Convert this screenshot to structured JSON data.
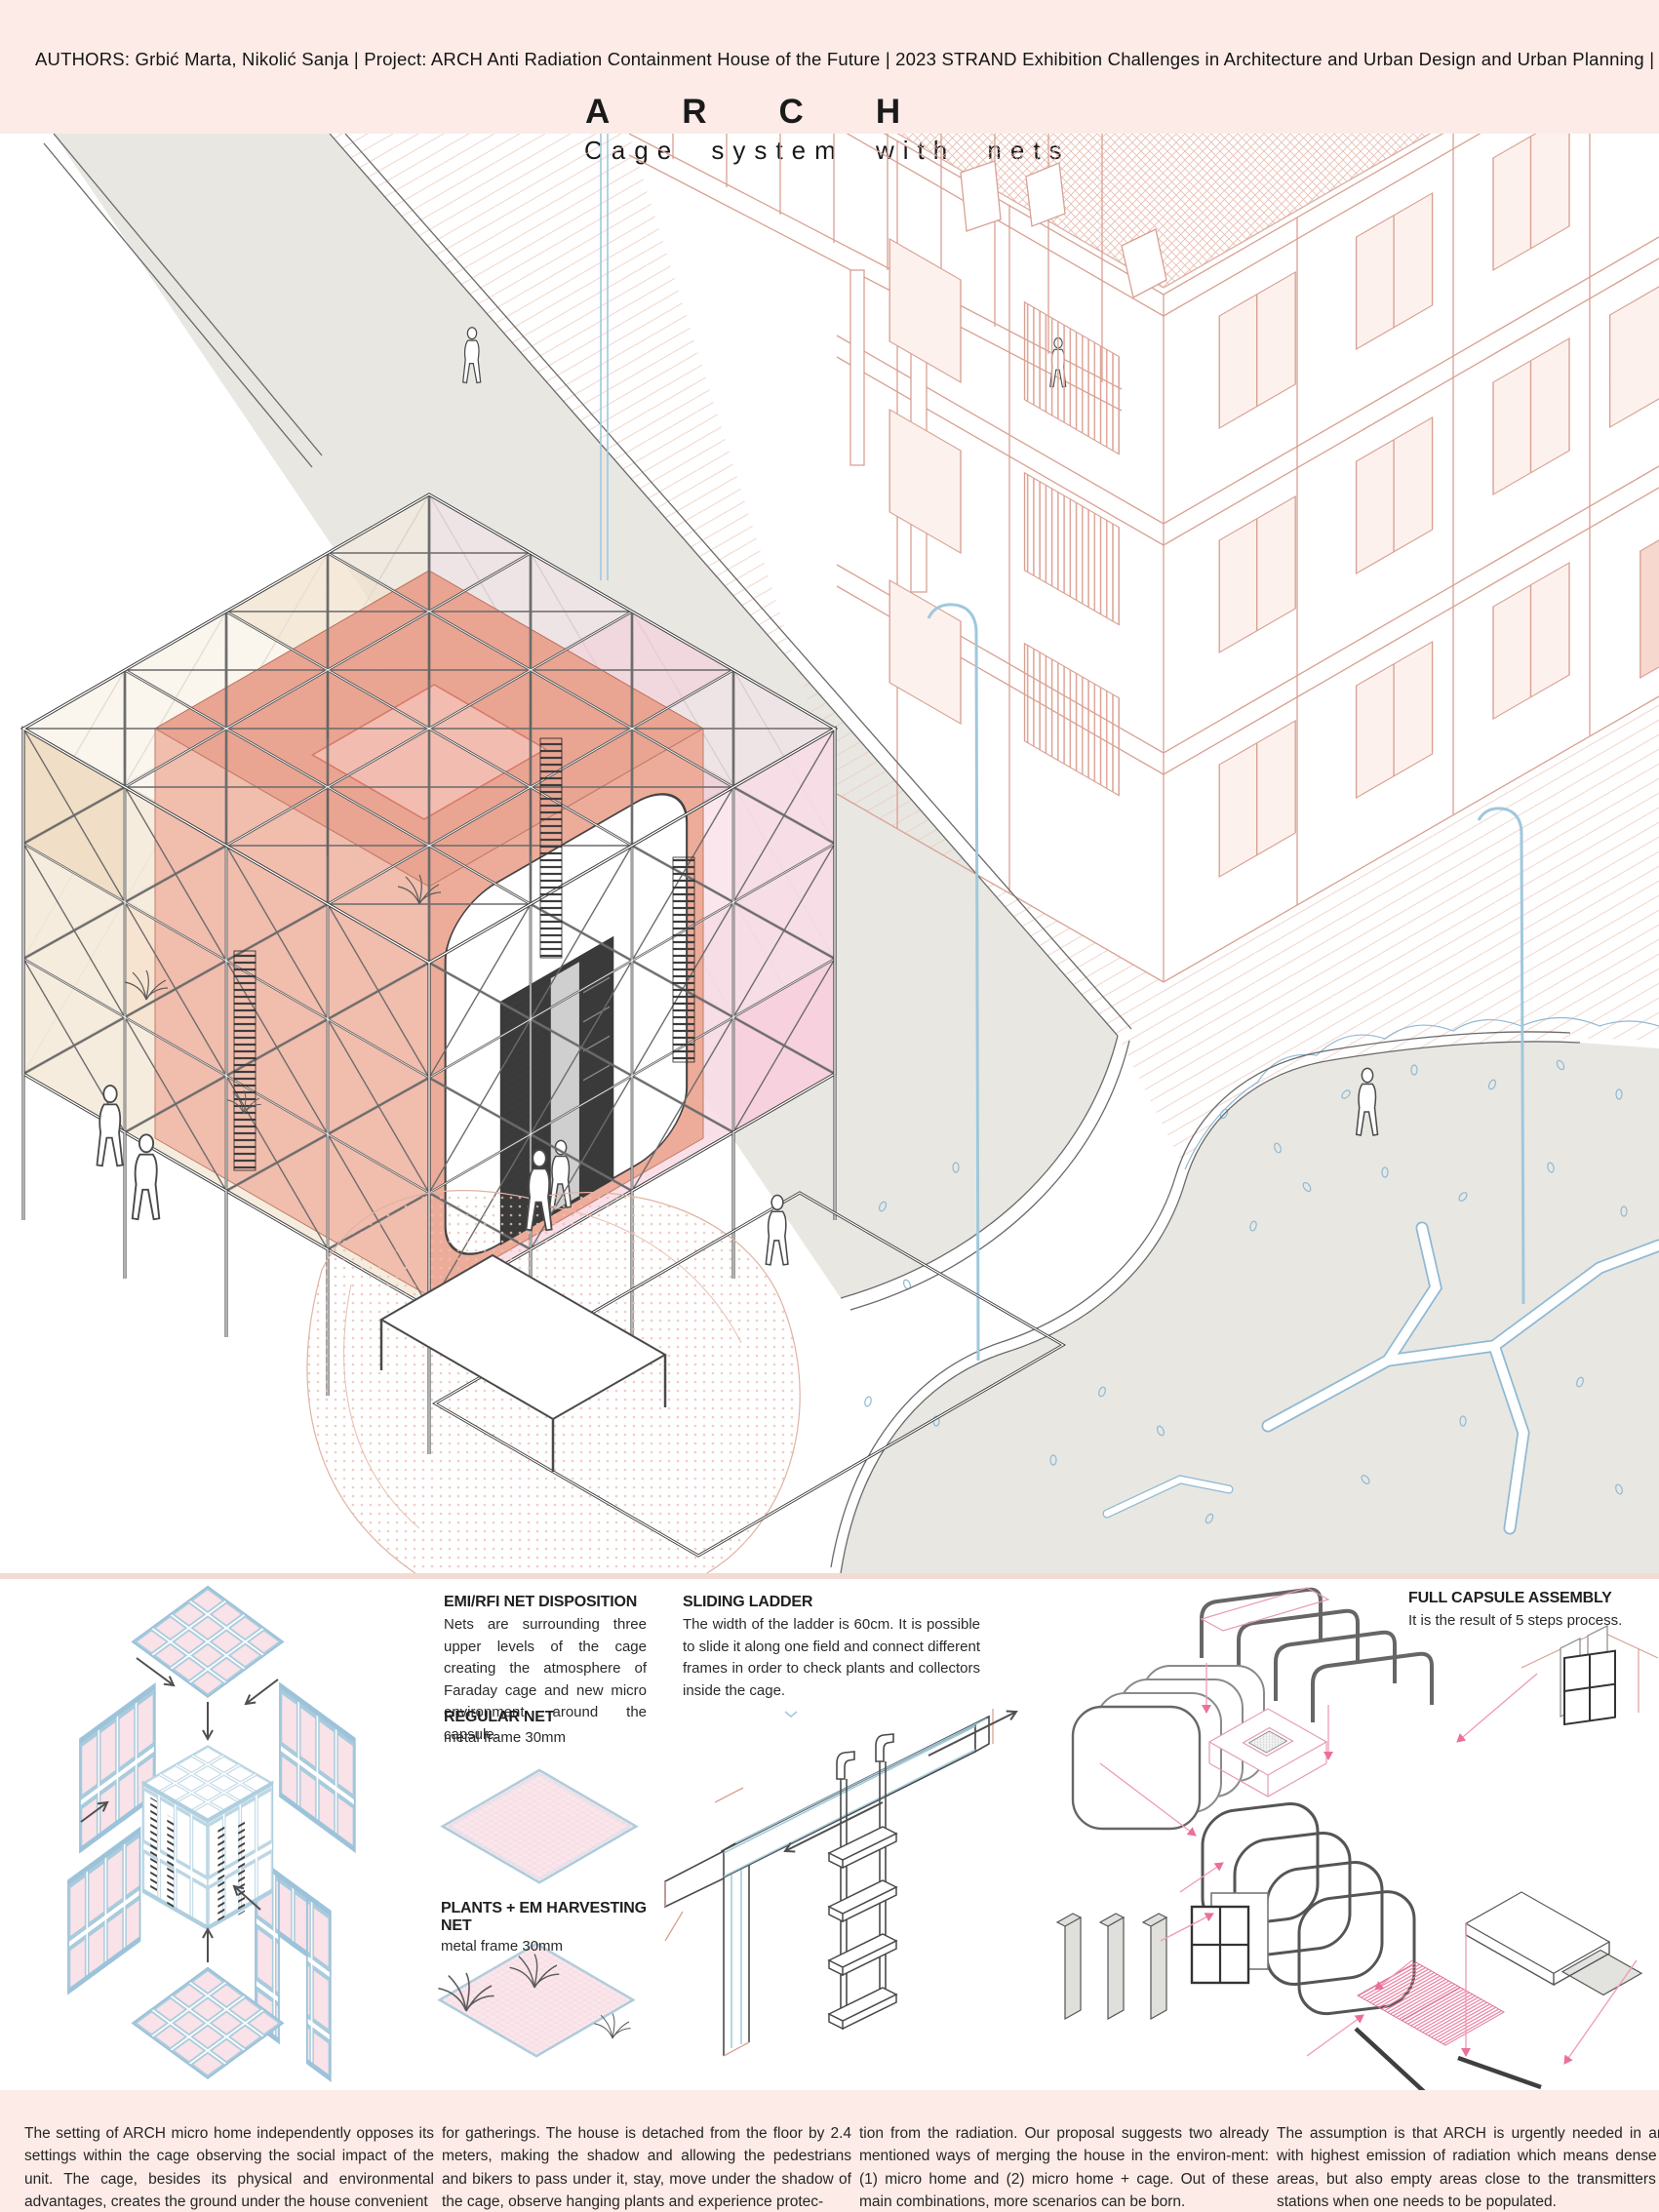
{
  "header": {
    "authors": "AUTHORS: Grbić Marta, Nikolić Sanja |  Project: ARCH Anti Radiation Containment House of the Future |  2023  STRAND Exhibition Challenges in Architecture and Urban Design and Urban Planning  |",
    "title": "ARCH",
    "subtitle": "Cage system with nets"
  },
  "diagrams": {
    "emi_net": {
      "title": "EMI/RFI NET DISPOSITION",
      "body": "Nets are surrounding three upper levels of the cage creating the atmosphere of Faraday cage and new micro environment around the capsule."
    },
    "regular_net": {
      "title": "REGULAR NET",
      "subtitle": "metal frame 30mm"
    },
    "plants_net": {
      "title": "PLANTS + EM HARVESTING NET",
      "subtitle": "metal frame 30mm"
    },
    "sliding_ladder": {
      "title": "SLIDING LADDER",
      "body": "The width of the ladder is 60cm. It is possible to slide it along one field and connect different frames in order to check plants and collectors inside the cage."
    },
    "full_capsule": {
      "title": "FULL CAPSULE ASSEMBLY",
      "body": "It is the result of 5 steps process."
    }
  },
  "footer": {
    "col1": "The setting of ARCH micro home independently opposes its settings within the cage observing the social impact of the unit. The cage, besides its physical and environmental advantages, creates the ground under the house convenient",
    "col2": "for gatherings. The house is detached from the floor by 2.4 meters, making the shadow and allowing the pedestrians and bikers to pass under it, stay, move under the shadow of the cage, observe hanging plants and experience protec-",
    "col3": "tion from the radiation. Our proposal suggests two already mentioned ways of merging the house in the environ-ment: (1) micro home and (2) micro home + cage. Out of these main combinations, more scenarios can be born.",
    "col4": "The assumption is that ARCH is urgently needed in areas with highest emission of radiation which means dense city areas, but also empty areas close to the transmitters cell stations when one needs to be populated."
  },
  "colors": {
    "header_pink": "#fcebe7",
    "divider_pink": "#f3dad2",
    "street_gray": "#e8e7e2",
    "building_salmon": "#d9a093",
    "net_blue": "#a9cbdc",
    "tree_blue": "#8fb9d4",
    "capsule_salmon": "#e9a492",
    "panel_cream": "#f4e9d7",
    "panel_pink": "#f8dbe5",
    "arrow_pink": "#ec6f9a",
    "line_dark": "#3f3f3f"
  }
}
